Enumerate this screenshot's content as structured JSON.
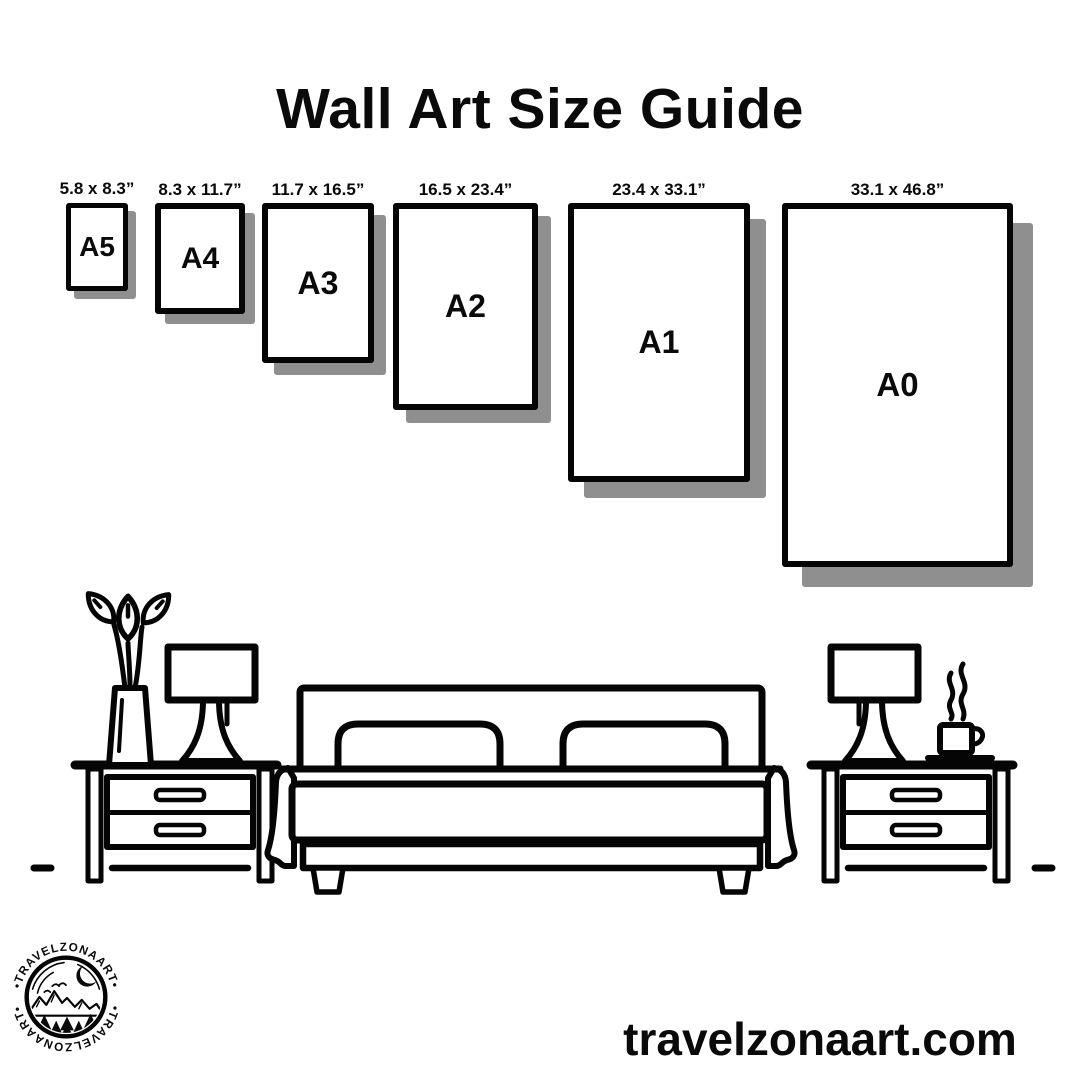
{
  "title": "Wall Art Size Guide",
  "sizes": [
    {
      "code": "A5",
      "dimensions": "5.8 x 8.3”"
    },
    {
      "code": "A4",
      "dimensions": "8.3 x 11.7”"
    },
    {
      "code": "A3",
      "dimensions": "11.7 x 16.5”"
    },
    {
      "code": "A2",
      "dimensions": "16.5 x 23.4”"
    },
    {
      "code": "A1",
      "dimensions": "23.4 x 33.1”"
    },
    {
      "code": "A0",
      "dimensions": "33.1 x 46.8”"
    }
  ],
  "logo": {
    "brand": "TRAVELZONAART",
    "arc_text_top": "•TRAVELZONAART•",
    "arc_text_bottom": "•TRAVELZONAART•"
  },
  "footer": {
    "website": "travelzonaart.com"
  },
  "colors": {
    "ink": "#050505",
    "paper_shadow": "#8f8f8f",
    "background": "#ffffff"
  }
}
